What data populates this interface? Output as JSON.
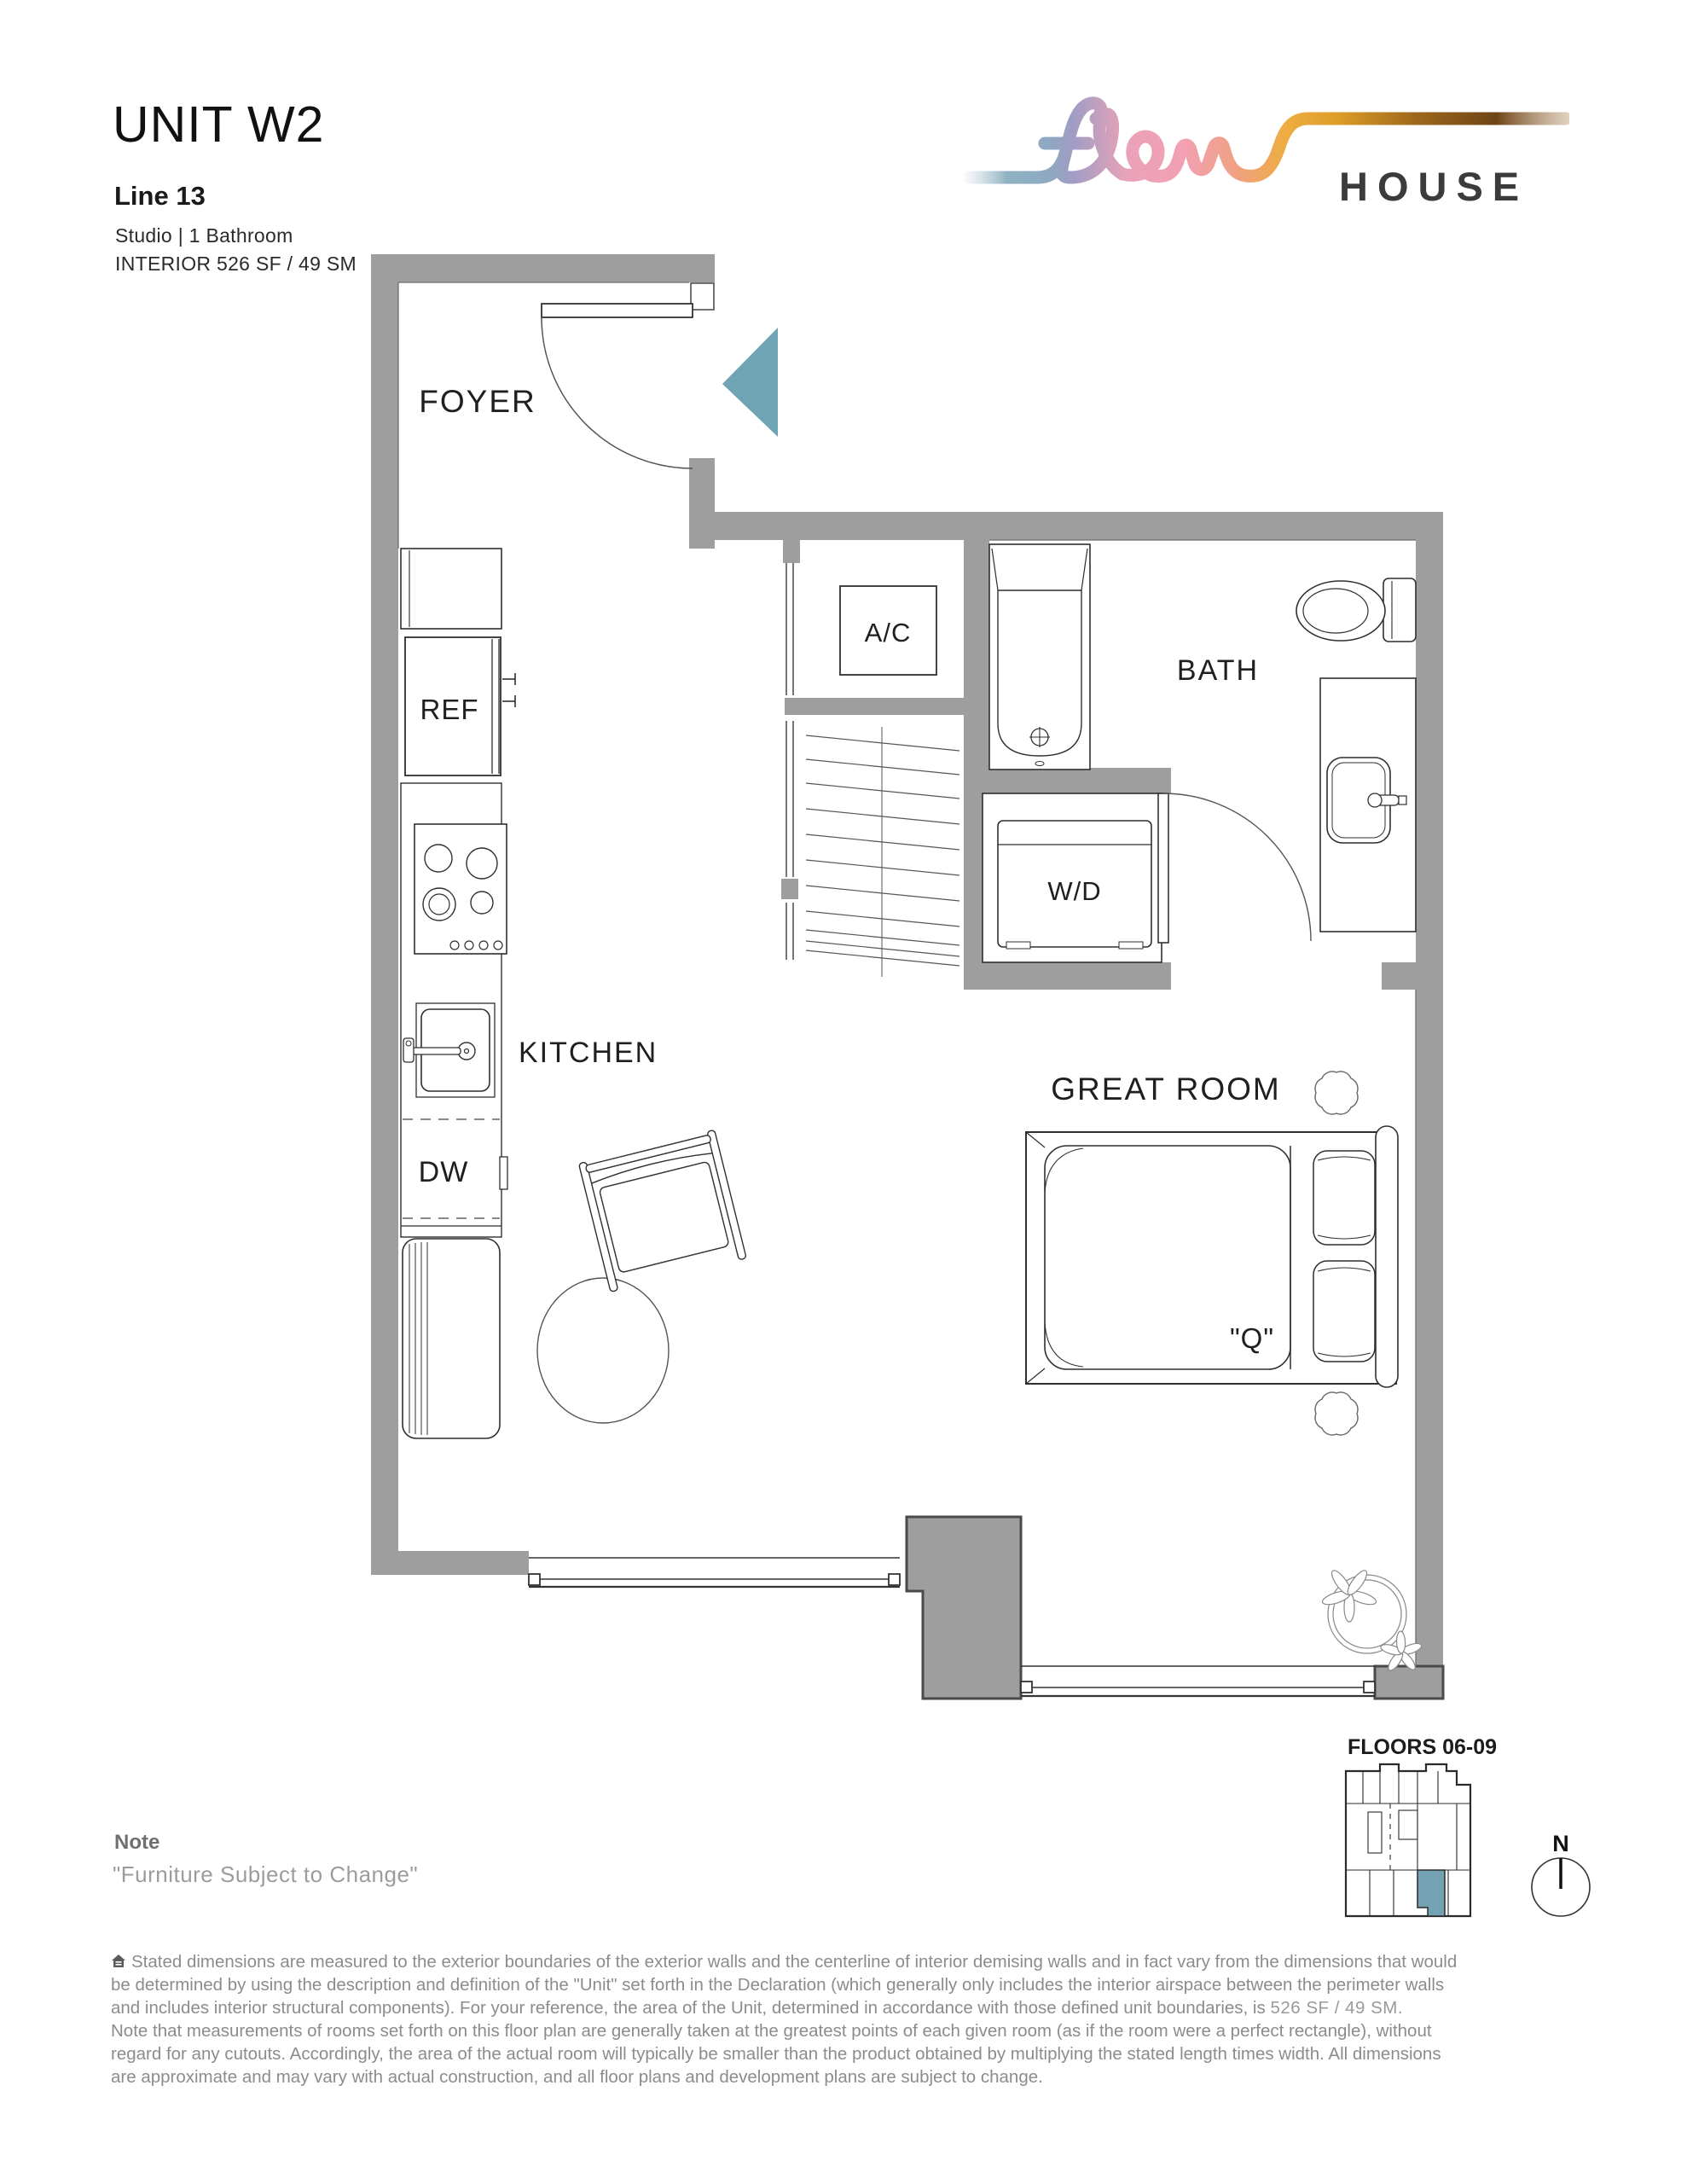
{
  "header": {
    "unit": "UNIT W2",
    "line": "Line 13",
    "config": "Studio | 1 Bathroom",
    "interior": "INTERIOR 526 SF / 49 SM"
  },
  "logo": {
    "house": "HOUSE"
  },
  "plan": {
    "labels": {
      "foyer": "FOYER",
      "ac": "A/C",
      "bath": "BATH",
      "ref": "REF",
      "wd": "W/D",
      "kitchen": "KITCHEN",
      "dw": "DW",
      "great_room": "GREAT ROOM",
      "bed_size": "\"Q\""
    }
  },
  "keyplan": {
    "floors": "FLOORS 06-09",
    "north": "N"
  },
  "note": {
    "title": "Note",
    "body": "\"Furniture Subject to Change\""
  },
  "disclaimer": {
    "line1": "Stated dimensions are measured to the exterior boundaries of the exterior walls and the centerline of interior demising walls and in fact vary from the dimensions that would",
    "line2": "be determined by using the description and definition of the \"Unit\" set forth in the Declaration (which generally only includes the interior airspace between the perimeter walls",
    "line3_pre": "and includes interior structural components).  For your reference, the area of the Unit, determined in accordance with those defined unit boundaries, is ",
    "line3_area": "526 SF / 49 SM.",
    "line4": "Note that measurements of rooms set forth on this floor plan are generally taken at the greatest points of each given room (as if the room were a perfect rectangle), without",
    "line5": "regard for any cutouts.  Accordingly, the area of the actual room will typically be smaller than the product obtained by multiplying the stated length times width.  All dimensions",
    "line6": "are approximate and may vary with actual construction, and all floor plans and development plans are subject to change."
  },
  "colors": {
    "accent": "#6fa4b5",
    "wall": "#9e9e9e",
    "keyplan_accent": "#74a2b2"
  }
}
